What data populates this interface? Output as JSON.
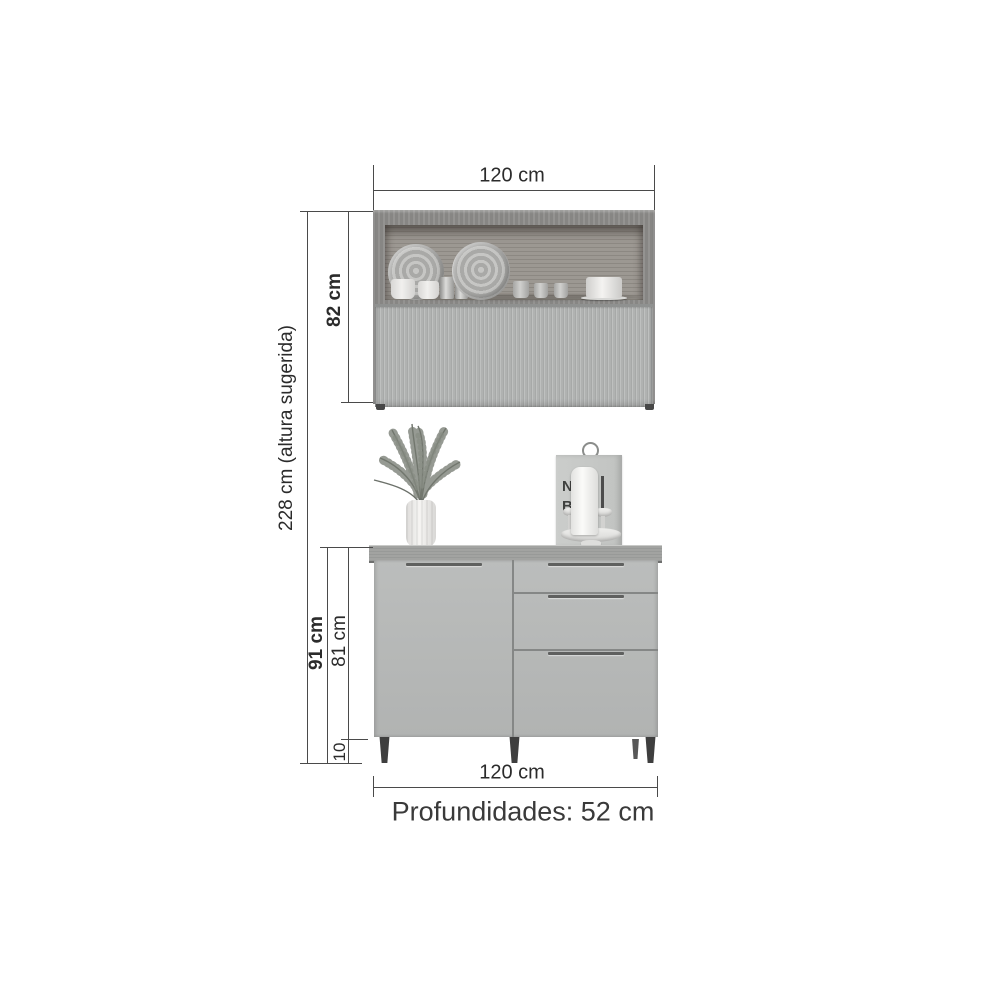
{
  "diagram": {
    "type": "furniture-dimension-diagram",
    "product": "kitchen cabinet set (wall cabinet + base cabinet)"
  },
  "dimensions": {
    "wall_cabinet_width": "120 cm",
    "wall_cabinet_height": "82 cm",
    "total_height": "228 cm (altura sugerida)",
    "base_cabinet_total_height": "91 cm",
    "base_cabinet_body_height": "81 cm",
    "leg_height": "10",
    "base_cabinet_width": "120 cm",
    "depth_note": "Profundidades: 52 cm"
  },
  "decor": {
    "board_letters": [
      "N",
      "B"
    ]
  },
  "colors": {
    "background": "#ffffff",
    "dimension_line": "#4a4a4a",
    "dimension_text": "#2b2b2b",
    "wood_frame": "#8e8d8b",
    "wood_interior": "#97928c",
    "fluted_door": "#b4b6b5",
    "countertop": "#a2a3a1",
    "cabinet_front": "#b7b9b8",
    "handle": "#5f605f",
    "legs": "#3e3e3e"
  }
}
